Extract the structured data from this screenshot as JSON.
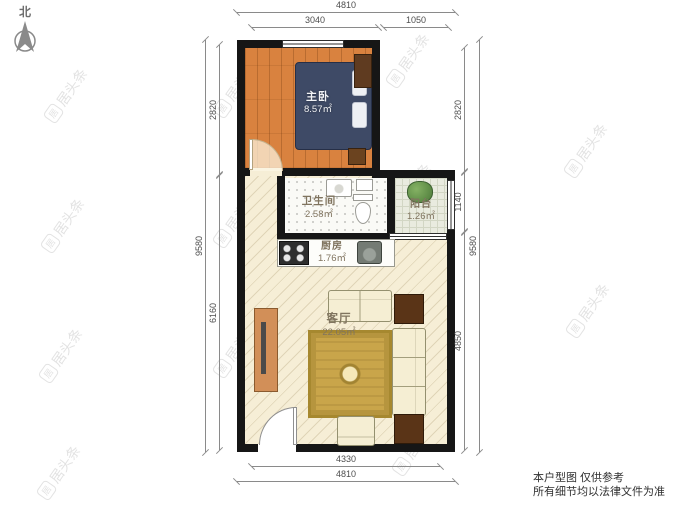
{
  "compass": {
    "label": "北"
  },
  "rooms": {
    "bedroom": {
      "name": "主卧",
      "area": "8.57㎡"
    },
    "bathroom": {
      "name": "卫生间",
      "area": "2.58㎡"
    },
    "balcony": {
      "name": "阳台",
      "area": "1.26㎡"
    },
    "kitchen": {
      "name": "厨房",
      "area": "1.76㎡"
    },
    "living_room": {
      "name": "客厅",
      "area": "22.05㎡"
    }
  },
  "dimensions": {
    "top": {
      "outer": "4810",
      "segment_left": "3040",
      "segment_right": "1050"
    },
    "bottom": {
      "inner": "4330",
      "outer": "4810"
    },
    "left": {
      "outer": "9580",
      "top": "2820",
      "bottom": "6160"
    },
    "right": {
      "outer": "9580",
      "top": "2820",
      "middle": "1140",
      "bottom": "4850"
    }
  },
  "footer": {
    "line1": "本户型图 仅供参考",
    "line2": "所有细节均以法律文件为准"
  },
  "watermark": {
    "icon_char": "居",
    "text": "居头条"
  },
  "colors": {
    "wall": "#161616",
    "wood_floor": "#d9823f",
    "living_floor": "#f6eed6",
    "bath_floor": "#fafaf6",
    "balcony_floor": "#e9ebdf",
    "bed": "#3e4a66",
    "sofa": "#f5eed3",
    "rug": "#c9a54a",
    "table": "#5a3417",
    "console": "#d28f58",
    "dimension": "#8a8a8a"
  }
}
